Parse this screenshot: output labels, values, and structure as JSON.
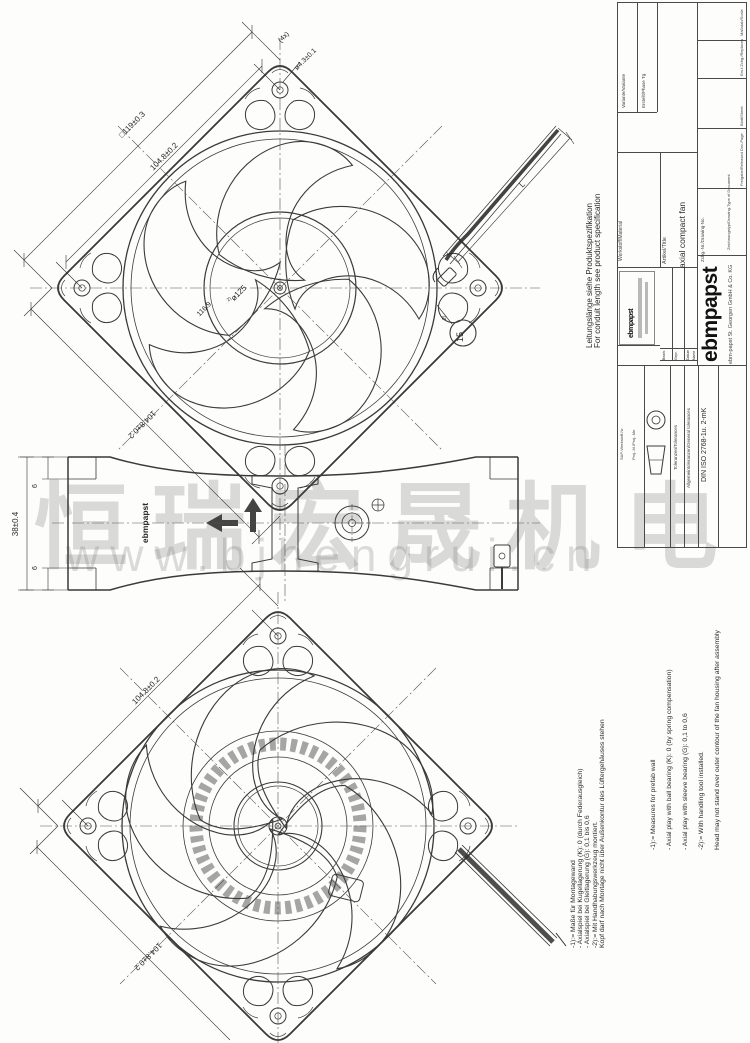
{
  "watermark": {
    "text_cn": "恒瑞宏晟机电",
    "text_url": "www.bjhengrui.cn"
  },
  "cable_note": {
    "line_de": "Leitungslänge siehe Produktspezifikation",
    "line_en": "For conduit length see product specification"
  },
  "notes": {
    "de": "-1):= Maße für Montagewand\n- Axialspiel bei Kugellagerung (K): 0 (durch Federausgleich)\n- Axialspiel bei Gleitlagerung (G): 0,1 bis 0,6\n-2):= Mit Handhabungswerkzeug montiert.\n         Kopf darf nach Montage nicht über Außenkontur des Lüftergehäuses stehen",
    "en": "-1):= Measures for prefab wall\n- Axial play with ball bearing (K): 0 (by spring compensation)\n- Axial play with sleeve bearing (G): 0,1 to 0,6\n-2):= With handling tool installed.\n         Head may not stand over outer contour of the fan housing after assembly"
  },
  "dimensions": {
    "frame_size": "□119±0.3",
    "hole_pitch": "104.8±0.2",
    "hole_pitch_bottom": "104.8±0.2",
    "hole_diameter": "ø4.3±0.1",
    "hole_count": "(4x)",
    "head_circle_ref": "2)",
    "head_circle": "ø125",
    "opening": "116.9",
    "cable_length": "L",
    "depth": "38±0.4",
    "flange_top": "6",
    "flange_bottom": "6",
    "head_callout": "15",
    "head_callout_ref": "2)",
    "back_pitch_top": "104.8±0.2",
    "back_pitch_bottom": "104.8±0.2"
  },
  "side_view": {
    "housing_logo": "ebmpapst"
  },
  "title_block": {
    "logo": "ebmpapst",
    "company": "ebm-papst St. Georgen GmbH & Co. KG",
    "variant_label": "Variante/Variante",
    "phase_label": "Erstellt/Phase Tg",
    "material_label": "Werkstoff/Material",
    "article_label": "Artikel/Title",
    "article_value": "axial compact fan",
    "drawing_no_label": "Zchg.-Nr./Drawing-No.",
    "scale_label": "Maßstab/Scale",
    "replaces_label": "Ers.f.Zchg./Replaces",
    "sheet_label": "Blatt/Sheet",
    "release_label": "Freigabe/Released Doc-Page",
    "doc_type_label": "Zeichnungstyp/Drawing-Type of Document",
    "sap_label": "SAP-Werkstoff-Nr.",
    "projection_label": "Proj.-M./Proj.-Me.",
    "tolerance_label": "Toleranzen/Tolerances",
    "general_tolerance_label": "Allgemeintoleranzen/General tolerances",
    "tolerance_standard": "DIN ISO 2768-1u. 2-mK",
    "approval": {
      "bearb": "Bearb.",
      "gepr": "Gepr.",
      "datum": "Datum",
      "name": "Name"
    }
  }
}
